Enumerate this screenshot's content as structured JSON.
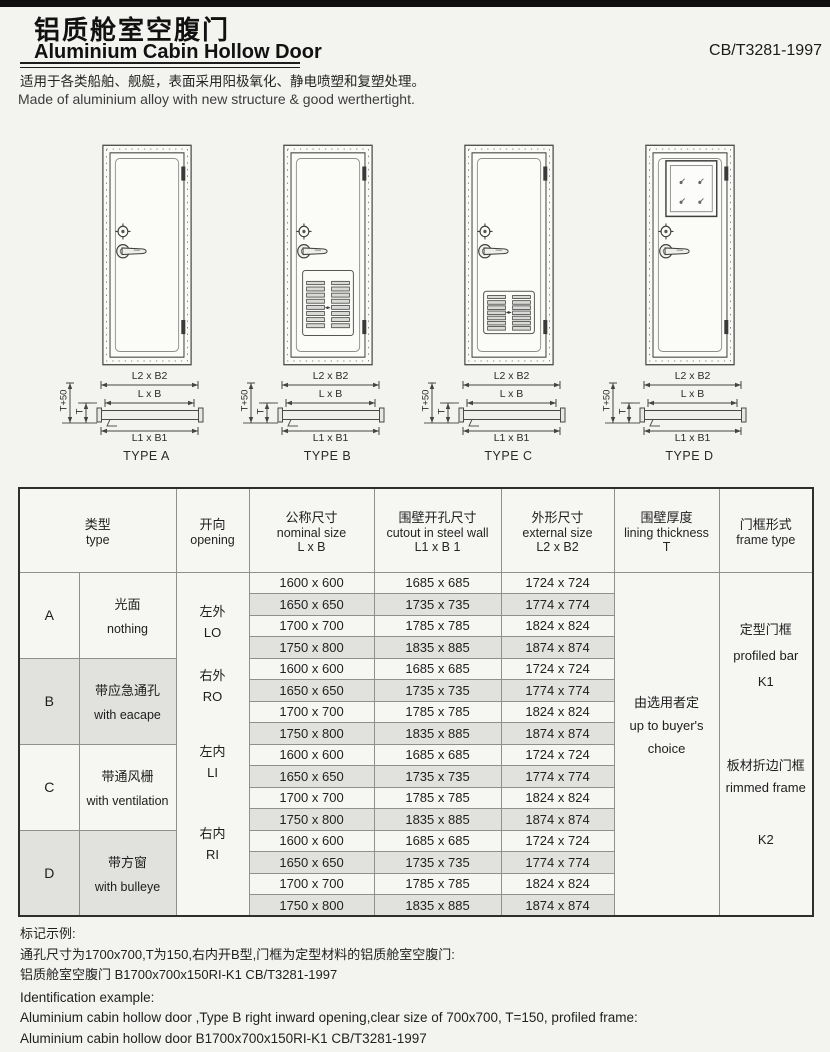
{
  "page": {
    "title_zh": "铝质舱室空腹门",
    "title_en": "Aluminium Cabin Hollow Door",
    "standard": "CB/T3281-1997",
    "desc_zh": "适用于各类船舶、舰艇，表面采用阳极氧化、静电喷塑和复塑处理。",
    "desc_en": "Made of aluminium alloy with new structure & good werthertight."
  },
  "figures": {
    "dim_labels": {
      "outer": "L2 x B2",
      "nominal": "L x B",
      "cutout": "L1 x B1",
      "wall": "T+50",
      "t": "T"
    },
    "types": [
      {
        "label": "TYPE A"
      },
      {
        "label": "TYPE B"
      },
      {
        "label": "TYPE C"
      },
      {
        "label": "TYPE D"
      }
    ]
  },
  "table": {
    "headers": {
      "type": {
        "zh": "类型",
        "en": "type"
      },
      "opening": {
        "zh": "开向",
        "en": "opening"
      },
      "nominal": {
        "zh": "公称尺寸",
        "en": "nominal size",
        "sub": "L x B"
      },
      "cutout": {
        "zh": "围壁开孔尺寸",
        "en": "cutout in steel wall",
        "sub": "L1 x B 1"
      },
      "external": {
        "zh": "外形尺寸",
        "en": "external size",
        "sub": "L2 x B2"
      },
      "lining": {
        "zh": "围壁厚度",
        "en": "lining thickness",
        "sub": "T"
      },
      "frame": {
        "zh": "门框形式",
        "en": "frame type"
      }
    },
    "groups": [
      {
        "letter": "A",
        "desc_zh": "光面",
        "desc_en": "nothing"
      },
      {
        "letter": "B",
        "desc_zh": "带应急通孔",
        "desc_en": "with eacape"
      },
      {
        "letter": "C",
        "desc_zh": "带通风栅",
        "desc_en": "with ventilation"
      },
      {
        "letter": "D",
        "desc_zh": "带方窗",
        "desc_en": "with bulleye"
      }
    ],
    "openings": [
      {
        "zh": "左外",
        "en": "LO"
      },
      {
        "zh": "右外",
        "en": "RO"
      },
      {
        "zh": "左内",
        "en": "LI"
      },
      {
        "zh": "右内",
        "en": "RI"
      }
    ],
    "rows": [
      {
        "nominal": "1600 x 600",
        "cutout": "1685 x 685",
        "external": "1724 x 724"
      },
      {
        "nominal": "1650 x 650",
        "cutout": "1735 x 735",
        "external": "1774 x 774"
      },
      {
        "nominal": "1700 x 700",
        "cutout": "1785 x 785",
        "external": "1824 x 824"
      },
      {
        "nominal": "1750 x 800",
        "cutout": "1835 x 885",
        "external": "1874 x 874"
      },
      {
        "nominal": "1600 x 600",
        "cutout": "1685 x 685",
        "external": "1724 x 724"
      },
      {
        "nominal": "1650 x 650",
        "cutout": "1735 x 735",
        "external": "1774 x 774"
      },
      {
        "nominal": "1700 x 700",
        "cutout": "1785 x 785",
        "external": "1824 x 824"
      },
      {
        "nominal": "1750 x 800",
        "cutout": "1835 x 885",
        "external": "1874 x 874"
      },
      {
        "nominal": "1600 x 600",
        "cutout": "1685 x 685",
        "external": "1724 x 724"
      },
      {
        "nominal": "1650 x 650",
        "cutout": "1735 x 735",
        "external": "1774 x 774"
      },
      {
        "nominal": "1700 x 700",
        "cutout": "1785 x 785",
        "external": "1824 x 824"
      },
      {
        "nominal": "1750 x 800",
        "cutout": "1835 x 885",
        "external": "1874 x 874"
      },
      {
        "nominal": "1600 x 600",
        "cutout": "1685 x 685",
        "external": "1724 x 724"
      },
      {
        "nominal": "1650 x 650",
        "cutout": "1735 x 735",
        "external": "1774 x 774"
      },
      {
        "nominal": "1700 x 700",
        "cutout": "1785 x 785",
        "external": "1824 x 824"
      },
      {
        "nominal": "1750 x 800",
        "cutout": "1835 x 885",
        "external": "1874 x 874"
      }
    ],
    "lining": {
      "zh": "由选用者定",
      "en_line1": "up to buyer's",
      "en_line2": "choice"
    },
    "frame": {
      "k1_zh": "定型门框",
      "k1_en": "profiled bar",
      "k1_code": "K1",
      "k2_zh": "板材折边门框",
      "k2_en": "rimmed frame",
      "k2_code": "K2"
    }
  },
  "footer": {
    "mark_title_zh": "标记示例:",
    "mark_zh_1": "通孔尺寸为1700x700,T为150,右内开B型,门框为定型材料的铝质舱室空腹门:",
    "mark_zh_2": "铝质舱室空腹门 B1700x700x150RI-K1 CB/T3281-1997",
    "mark_title_en": "Identification example:",
    "mark_en_1": "Aluminium cabin hollow door ,Type B right inward opening,clear size of 700x700, T=150, profiled frame:",
    "mark_en_2": "Aluminium cabin hollow door B1700x700x150RI-K1 CB/T3281-1997"
  },
  "colors": {
    "page_bg": "#f3f3f0",
    "stripe": "#e1e1de",
    "rule": "#1c1c1c",
    "top_bar": "#101010"
  }
}
